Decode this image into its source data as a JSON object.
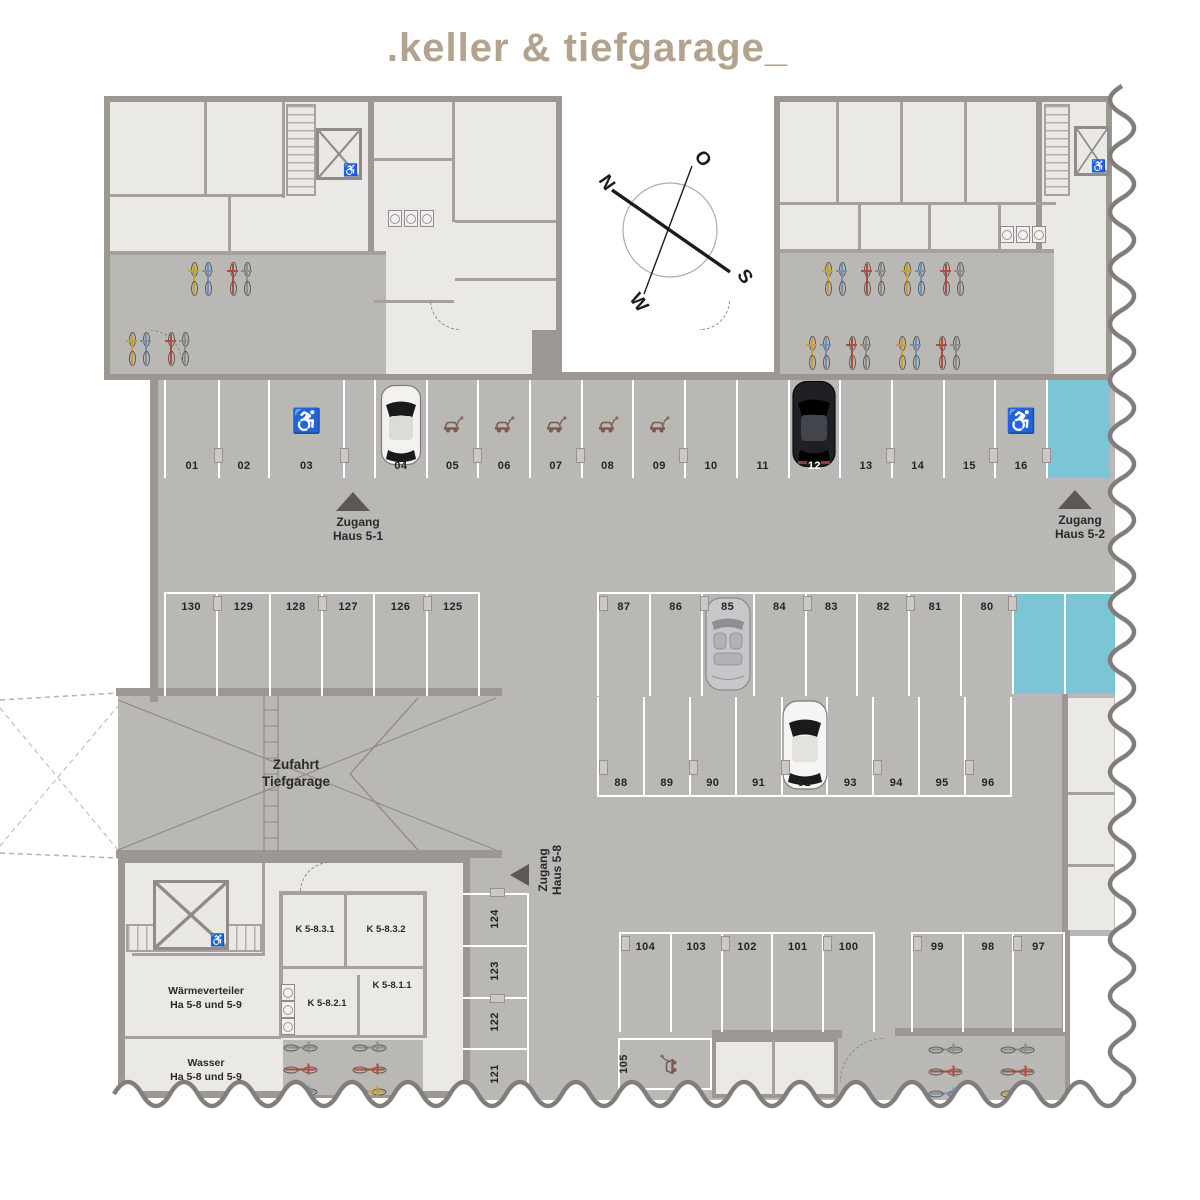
{
  "title": ".keller & tiefgarage_",
  "compass": {
    "north": "N",
    "east": "O",
    "south": "S",
    "west": "W"
  },
  "access": {
    "haus51": [
      "Zugang",
      "Haus 5-1"
    ],
    "haus52": [
      "Zugang",
      "Haus 5-2"
    ],
    "haus58": [
      "Zugang",
      "Haus 5-8"
    ]
  },
  "rooms": {
    "ramp": [
      "Zufahrt",
      "Tiefgarage"
    ],
    "k5831": "K 5-8.3.1",
    "k5832": "K 5-8.3.2",
    "k5811": "K 5-8.1.1",
    "k5821": "K 5-8.2.1",
    "waermeverteiler": [
      "Wärmeverteiler",
      "Ha 5-8 und 5-9"
    ],
    "wasser": [
      "Wasser",
      "Ha 5-8 und 5-9"
    ]
  },
  "parking": {
    "row_north": [
      "01",
      "02",
      "03",
      "04",
      "05",
      "06",
      "07",
      "08",
      "09",
      "10",
      "11",
      "12",
      "13",
      "14",
      "15",
      "16"
    ],
    "row_mid_west": [
      "130",
      "129",
      "128",
      "127",
      "126",
      "125"
    ],
    "row_mid_east_upper": [
      "87",
      "86",
      "85",
      "84",
      "83",
      "82",
      "81",
      "80"
    ],
    "row_mid_east_lower": [
      "88",
      "89",
      "90",
      "91",
      "92",
      "93",
      "94",
      "95",
      "96"
    ],
    "row_south_left": [
      "104",
      "103",
      "102",
      "101",
      "100"
    ],
    "row_south_right": [
      "99",
      "98",
      "97"
    ],
    "column_west": [
      "124",
      "123",
      "122",
      "121"
    ],
    "moto_spot": "105"
  },
  "colors": {
    "accent_blue": "#7cc5d6",
    "title_tan": "#b3a28e",
    "floor_gray": "#b9b8b5",
    "room_light": "#ebe9e6",
    "wall_gray": "#9c9793",
    "marker_dark": "#5f5754",
    "ev_brown": "#7b5a50"
  }
}
